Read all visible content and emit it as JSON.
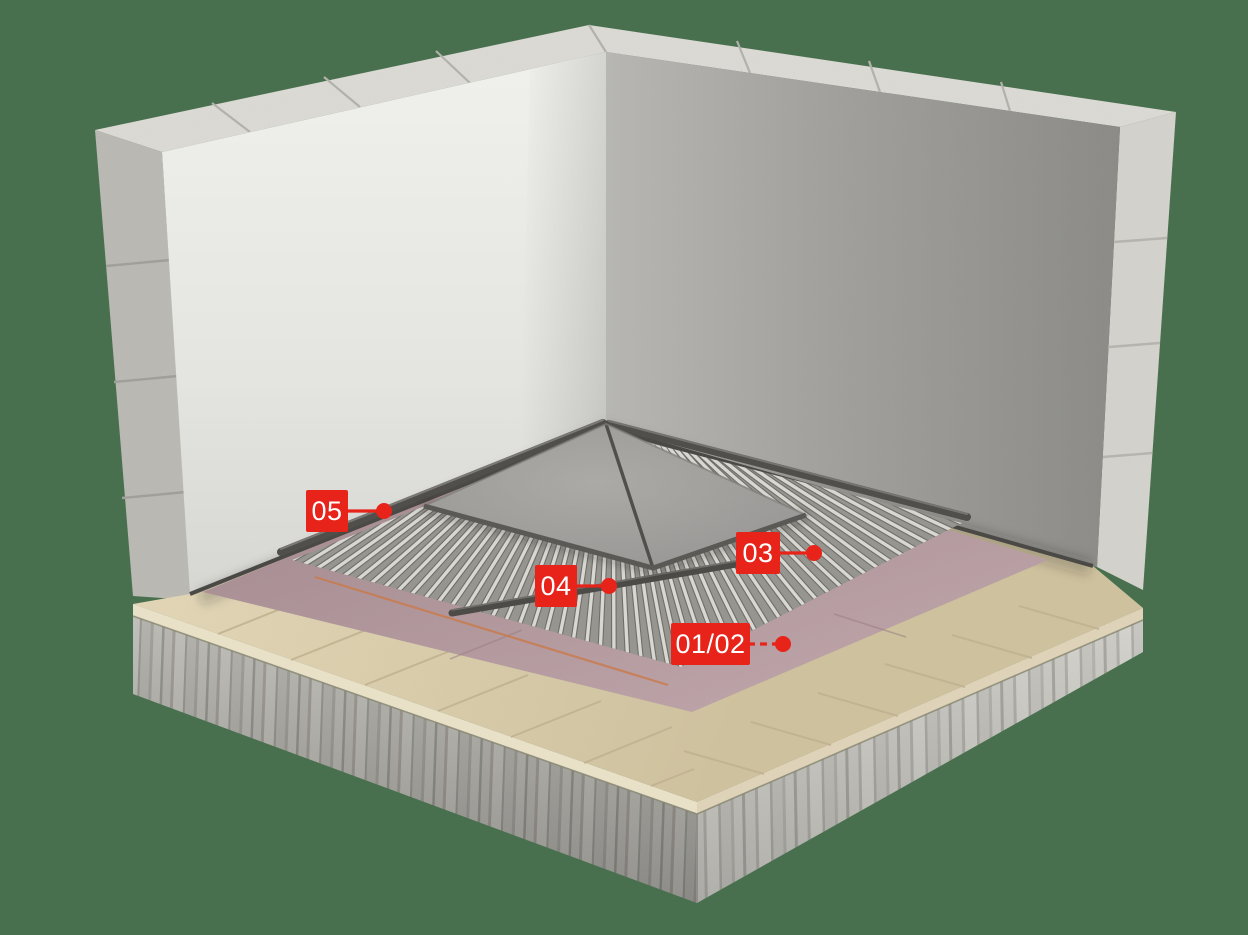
{
  "figure": {
    "type": "3d-cutaway-floor-construction-diagram",
    "background_color": "#49704E"
  },
  "palette": {
    "background": "#49704E",
    "callout_red": "#E8231A",
    "callout_text": "#FFFFFF",
    "wall_plaster": "#E9E9E5",
    "wall_shadow_face": "#9A9995",
    "concrete_block": "#C9C8C2",
    "slab_concrete": "#B3B2AC",
    "bedding_beige": "#D8CAA7",
    "screed_pink": "#B0969B",
    "mat_rib_gray": "#D8D7D2",
    "mat_base_gray": "#96958F",
    "profile_dark": "#514F4B",
    "tile_gray": "#9E9D99",
    "marker_line_orange": "#C97C4F"
  },
  "callouts": {
    "color": "#E8231A",
    "text_color": "#FFFFFF",
    "leader_width": 3.2,
    "dot_radius": 8,
    "items": [
      {
        "text": "05",
        "box": {
          "x": 306,
          "y": 490,
          "w": 42,
          "h": 42
        },
        "dot": {
          "x": 384,
          "y": 511
        },
        "leader_dashed": false
      },
      {
        "text": "04",
        "box": {
          "x": 535,
          "y": 565,
          "w": 42,
          "h": 42
        },
        "dot": {
          "x": 609,
          "y": 586
        },
        "leader_dashed": false
      },
      {
        "text": "03",
        "box": {
          "x": 736,
          "y": 532,
          "w": 44,
          "h": 42
        },
        "dot": {
          "x": 814,
          "y": 553
        },
        "leader_dashed": false
      },
      {
        "text": "01/02",
        "box": {
          "x": 671,
          "y": 623,
          "w": 79,
          "h": 42
        },
        "dot": {
          "x": 783,
          "y": 644
        },
        "leader_dashed": true
      }
    ]
  }
}
